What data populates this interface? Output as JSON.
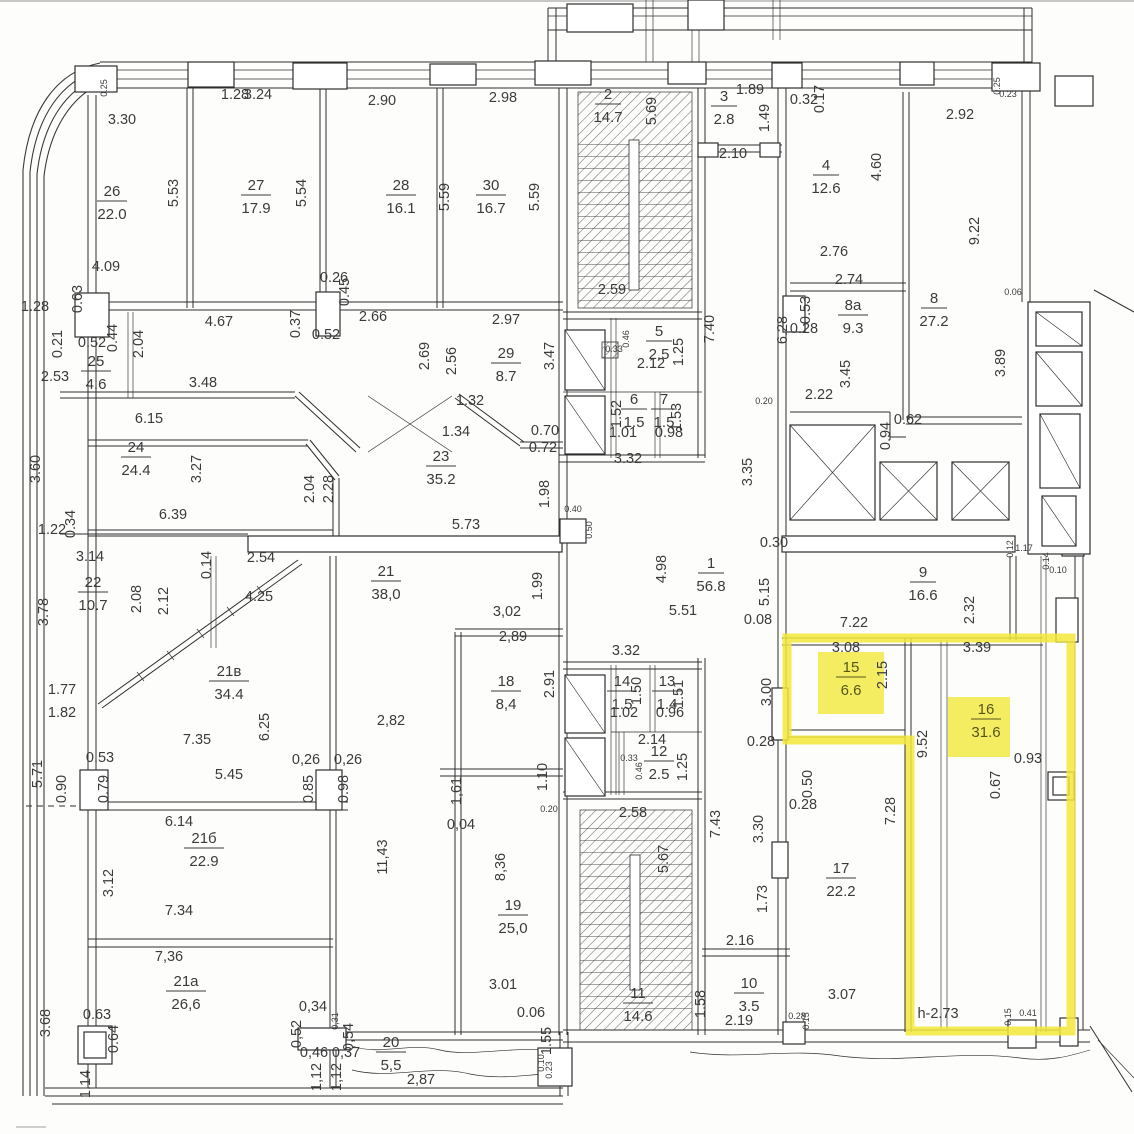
{
  "meta": {
    "title": "Scanned floor plan with rooms 15 and 16 highlighted",
    "highlight_note": "h-2.73"
  },
  "colors": {
    "highlight": "#f2e83a",
    "line": "#2f2f2f",
    "paper": "#fdfdfc"
  },
  "rooms": [
    [
      "26",
      "22.0",
      112,
      196,
      0
    ],
    [
      "27",
      "17.9",
      256,
      190,
      0
    ],
    [
      "28",
      "16.1",
      401,
      190,
      0
    ],
    [
      "30",
      "16.7",
      491,
      190,
      0
    ],
    [
      "2",
      "14.7",
      608,
      99,
      0
    ],
    [
      "3",
      "2.8",
      724,
      101,
      0
    ],
    [
      "4",
      "12.6",
      826,
      170,
      0
    ],
    [
      "8а",
      "9.3",
      853,
      310,
      0
    ],
    [
      "8",
      "27.2",
      934,
      303,
      0
    ],
    [
      "25",
      "4.6",
      96,
      366,
      0
    ],
    [
      "29",
      "8.7",
      506,
      358,
      0
    ],
    [
      "24",
      "24.4",
      136,
      452,
      0
    ],
    [
      "23",
      "35.2",
      441,
      461,
      0
    ],
    [
      "22",
      "10.7",
      93,
      587,
      0
    ],
    [
      "21",
      "38,0",
      386,
      576,
      0
    ],
    [
      "21в",
      "34.4",
      229,
      676,
      0
    ],
    [
      "1",
      "56.8",
      711,
      568,
      0
    ],
    [
      "9",
      "16.6",
      923,
      577,
      0
    ],
    [
      "5",
      "2.5",
      659,
      336,
      0
    ],
    [
      "6",
      "1.5",
      634,
      404,
      0
    ],
    [
      "7",
      "1.5",
      664,
      404,
      0
    ],
    [
      "14",
      "1.5",
      622,
      686,
      0
    ],
    [
      "13",
      "1.4",
      667,
      686,
      0
    ],
    [
      "12",
      "2.5",
      659,
      756,
      0
    ],
    [
      "18",
      "8,4",
      506,
      686,
      0
    ],
    [
      "15",
      "6.6",
      851,
      672,
      1
    ],
    [
      "16",
      "31.6",
      986,
      714,
      1
    ],
    [
      "17",
      "22.2",
      841,
      873,
      0
    ],
    [
      "21б",
      "22.9",
      204,
      843,
      0
    ],
    [
      "21а",
      "26,6",
      186,
      986,
      0
    ],
    [
      "19",
      "25,0",
      513,
      910,
      0
    ],
    [
      "20",
      "5,5",
      391,
      1047,
      0
    ],
    [
      "11",
      "14.6",
      638,
      998,
      0
    ],
    [
      "10",
      "3.5",
      749,
      988,
      0
    ]
  ],
  "dimensions": [
    [
      "1.28",
      235,
      99,
      ""
    ],
    [
      "3.30",
      122,
      124,
      ""
    ],
    [
      "0.25",
      107,
      88,
      "rs"
    ],
    [
      "3.24",
      258,
      99,
      ""
    ],
    [
      "2.90",
      382,
      105,
      ""
    ],
    [
      "2.98",
      503,
      102,
      ""
    ],
    [
      "1.89",
      750,
      94,
      ""
    ],
    [
      "1.49",
      769,
      118,
      "r"
    ],
    [
      "0.32",
      804,
      104,
      ""
    ],
    [
      "0.17",
      824,
      99,
      "r"
    ],
    [
      "2.92",
      960,
      119,
      ""
    ],
    [
      "0.25",
      1000,
      86,
      "rs"
    ],
    [
      "0.23",
      1008,
      97,
      "s"
    ],
    [
      "2.10",
      733,
      158,
      ""
    ],
    [
      "5.53",
      178,
      193,
      "r"
    ],
    [
      "5.54",
      306,
      193,
      "r"
    ],
    [
      "5.59",
      449,
      197,
      "r"
    ],
    [
      "5.59",
      539,
      197,
      "r"
    ],
    [
      "5.69",
      656,
      111,
      "r"
    ],
    [
      "4.60",
      881,
      167,
      "r"
    ],
    [
      "9.22",
      979,
      231,
      "r"
    ],
    [
      "4.09",
      106,
      271,
      ""
    ],
    [
      "2.59",
      612,
      294,
      ""
    ],
    [
      "2.76",
      834,
      256,
      ""
    ],
    [
      "2.74",
      849,
      284,
      ""
    ],
    [
      "0.63",
      82,
      299,
      "r"
    ],
    [
      "1.28",
      35,
      311,
      ""
    ],
    [
      "0.21",
      62,
      344,
      "r"
    ],
    [
      "0.52",
      92,
      347,
      ""
    ],
    [
      "0.44",
      117,
      338,
      "r"
    ],
    [
      "2.04",
      143,
      344,
      "r"
    ],
    [
      "4.67",
      219,
      326,
      ""
    ],
    [
      "0.37",
      300,
      324,
      "r"
    ],
    [
      "0.52",
      326,
      339,
      ""
    ],
    [
      "0.26",
      334,
      282,
      ""
    ],
    [
      "0.45",
      349,
      292,
      "r"
    ],
    [
      "2.66",
      373,
      321,
      ""
    ],
    [
      "2.97",
      506,
      324,
      ""
    ],
    [
      "2.53",
      55,
      381,
      ""
    ],
    [
      "3.48",
      203,
      387,
      ""
    ],
    [
      "0.53",
      810,
      310,
      "r"
    ],
    [
      "0.28",
      804,
      333,
      ""
    ],
    [
      "6.28",
      787,
      330,
      "r"
    ],
    [
      "3.45",
      850,
      374,
      "r"
    ],
    [
      "3.89",
      1005,
      363,
      "r"
    ],
    [
      "0.06",
      1013,
      295,
      "s"
    ],
    [
      "2.69",
      429,
      356,
      "r"
    ],
    [
      "2.56",
      456,
      361,
      "r"
    ],
    [
      "3.47",
      554,
      356,
      "r"
    ],
    [
      "0.46",
      629,
      339,
      "rs"
    ],
    [
      "0.33",
      614,
      352,
      "s"
    ],
    [
      "2.12",
      651,
      368,
      ""
    ],
    [
      "1.25",
      683,
      352,
      "r"
    ],
    [
      "1.52",
      621,
      414,
      "r"
    ],
    [
      "1.53",
      681,
      417,
      "r"
    ],
    [
      "1.01",
      623,
      437,
      ""
    ],
    [
      "0.98",
      669,
      437,
      ""
    ],
    [
      "2.22",
      819,
      399,
      ""
    ],
    [
      "0.20",
      764,
      404,
      "s"
    ],
    [
      "0.62",
      908,
      424,
      ""
    ],
    [
      "0.94",
      890,
      436,
      "r"
    ],
    [
      "6.15",
      149,
      423,
      ""
    ],
    [
      "3.60",
      40,
      469,
      "r"
    ],
    [
      "3.27",
      201,
      469,
      "r"
    ],
    [
      "1.32",
      470,
      405,
      ""
    ],
    [
      "1.34",
      456,
      436,
      ""
    ],
    [
      "0.70",
      545,
      435,
      ""
    ],
    [
      "0.72",
      543,
      452,
      ""
    ],
    [
      "2.04",
      314,
      489,
      "r"
    ],
    [
      "2.28",
      333,
      489,
      "r"
    ],
    [
      "1.98",
      549,
      494,
      "r"
    ],
    [
      "3.32",
      628,
      463,
      ""
    ],
    [
      "3.35",
      752,
      472,
      "r"
    ],
    [
      "7.40",
      714,
      329,
      "r"
    ],
    [
      "1.22",
      52,
      534,
      ""
    ],
    [
      "0.34",
      75,
      524,
      "r"
    ],
    [
      "6.39",
      173,
      519,
      ""
    ],
    [
      "5.73",
      466,
      529,
      ""
    ],
    [
      "0.40",
      573,
      512,
      "s"
    ],
    [
      "0.50",
      592,
      530,
      "rs"
    ],
    [
      "0.30",
      774,
      547,
      ""
    ],
    [
      "3.14",
      90,
      561,
      ""
    ],
    [
      "0.14",
      211,
      565,
      "r"
    ],
    [
      "2.54",
      261,
      562,
      ""
    ],
    [
      "4.98",
      666,
      569,
      "r"
    ],
    [
      "5.15",
      769,
      592,
      "r"
    ],
    [
      "1.99",
      542,
      586,
      "r"
    ],
    [
      "2.08",
      141,
      599,
      "r"
    ],
    [
      "2.12",
      168,
      601,
      "r"
    ],
    [
      "4.25",
      259,
      601,
      ""
    ],
    [
      "3.78",
      48,
      612,
      "r"
    ],
    [
      "2.32",
      974,
      610,
      "r"
    ],
    [
      "0.08",
      758,
      624,
      ""
    ],
    [
      "7.22",
      854,
      627,
      ""
    ],
    [
      "5.51",
      683,
      615,
      ""
    ],
    [
      "3,02",
      507,
      616,
      ""
    ],
    [
      "2,89",
      513,
      641,
      ""
    ],
    [
      "3.08",
      846,
      652,
      ""
    ],
    [
      "3.39",
      977,
      652,
      ""
    ],
    [
      "3.32",
      626,
      655,
      ""
    ],
    [
      "2.91",
      554,
      684,
      "r"
    ],
    [
      "2.15",
      887,
      675,
      "r"
    ],
    [
      "1.50",
      641,
      691,
      "r"
    ],
    [
      "1.51",
      683,
      694,
      "r"
    ],
    [
      "3.00",
      771,
      692,
      "r"
    ],
    [
      "1.02",
      624,
      717,
      ""
    ],
    [
      "0.96",
      670,
      717,
      ""
    ],
    [
      "1.77",
      62,
      694,
      ""
    ],
    [
      "1.82",
      62,
      717,
      ""
    ],
    [
      "6.25",
      269,
      727,
      "r"
    ],
    [
      "9.52",
      927,
      744,
      "r"
    ],
    [
      "2.14",
      652,
      744,
      ""
    ],
    [
      "0.28",
      761,
      746,
      ""
    ],
    [
      "2,82",
      391,
      725,
      ""
    ],
    [
      "7.35",
      197,
      744,
      ""
    ],
    [
      "0.33",
      629,
      761,
      "s"
    ],
    [
      "0.46",
      642,
      771,
      "rs"
    ],
    [
      "1.25",
      687,
      767,
      "r"
    ],
    [
      "0.93",
      1028,
      763,
      ""
    ],
    [
      "0.67",
      1000,
      785,
      "r"
    ],
    [
      "5.71",
      42,
      774,
      "r"
    ],
    [
      "0.53",
      100,
      762,
      ""
    ],
    [
      "0.79",
      108,
      789,
      "r"
    ],
    [
      "0.90",
      66,
      789,
      "r"
    ],
    [
      "5.45",
      229,
      779,
      ""
    ],
    [
      "0,26",
      306,
      764,
      ""
    ],
    [
      "0,26",
      348,
      764,
      ""
    ],
    [
      "0.85",
      313,
      789,
      "r"
    ],
    [
      "0.98",
      348,
      789,
      "r"
    ],
    [
      "0.50",
      812,
      784,
      "r"
    ],
    [
      "0.28",
      803,
      809,
      ""
    ],
    [
      "1,61",
      461,
      791,
      "r"
    ],
    [
      "1.10",
      547,
      777,
      "r"
    ],
    [
      "0.20",
      549,
      812,
      "s"
    ],
    [
      "2.58",
      633,
      817,
      ""
    ],
    [
      "7.28",
      895,
      811,
      "r"
    ],
    [
      "7.43",
      720,
      824,
      "r"
    ],
    [
      "3.30",
      763,
      829,
      "r"
    ],
    [
      "6.14",
      179,
      826,
      ""
    ],
    [
      "5.67",
      668,
      859,
      "r"
    ],
    [
      "0,04",
      461,
      829,
      ""
    ],
    [
      "8,36",
      505,
      867,
      "r"
    ],
    [
      "11,43",
      387,
      857,
      "r"
    ],
    [
      "3.12",
      113,
      883,
      "r"
    ],
    [
      "1.73",
      767,
      899,
      "r"
    ],
    [
      "7.34",
      179,
      915,
      ""
    ],
    [
      "7,36",
      169,
      961,
      ""
    ],
    [
      "2.16",
      740,
      945,
      ""
    ],
    [
      "3.01",
      503,
      989,
      ""
    ],
    [
      "3.07",
      842,
      999,
      ""
    ],
    [
      "1.58",
      705,
      1004,
      "r"
    ],
    [
      "2.19",
      739,
      1025,
      ""
    ],
    [
      "0.28",
      797,
      1019,
      "s"
    ],
    [
      "0.15",
      809,
      1021,
      "rs"
    ],
    [
      "h-2.73",
      938,
      1018,
      ""
    ],
    [
      "0.15",
      1011,
      1017,
      "rs"
    ],
    [
      "0.41",
      1028,
      1016,
      "s"
    ],
    [
      "3.68",
      50,
      1023,
      "r"
    ],
    [
      "0.63",
      97,
      1019,
      ""
    ],
    [
      "0.64",
      118,
      1039,
      "r"
    ],
    [
      "0,34",
      313,
      1011,
      ""
    ],
    [
      "0,52",
      301,
      1034,
      "r"
    ],
    [
      "0,31",
      338,
      1021,
      "rs"
    ],
    [
      "0,54",
      353,
      1037,
      "r"
    ],
    [
      "0,46",
      314,
      1057,
      ""
    ],
    [
      "0,37",
      346,
      1057,
      ""
    ],
    [
      "1,12",
      321,
      1077,
      "r"
    ],
    [
      "1,12",
      341,
      1077,
      "r"
    ],
    [
      "1.14",
      90,
      1084,
      "r"
    ],
    [
      "2,87",
      421,
      1084,
      ""
    ],
    [
      "0.06",
      531,
      1017,
      ""
    ],
    [
      "1.55",
      551,
      1041,
      "r"
    ],
    [
      "0.10",
      544,
      1063,
      "rs"
    ],
    [
      "0.23",
      552,
      1070,
      "rs"
    ],
    [
      "1.17",
      1024,
      551,
      "s"
    ],
    [
      "0.12",
      1013,
      549,
      "rs"
    ],
    [
      "0.14",
      1049,
      561,
      "rs"
    ],
    [
      "0.10",
      1058,
      573,
      "s"
    ]
  ]
}
